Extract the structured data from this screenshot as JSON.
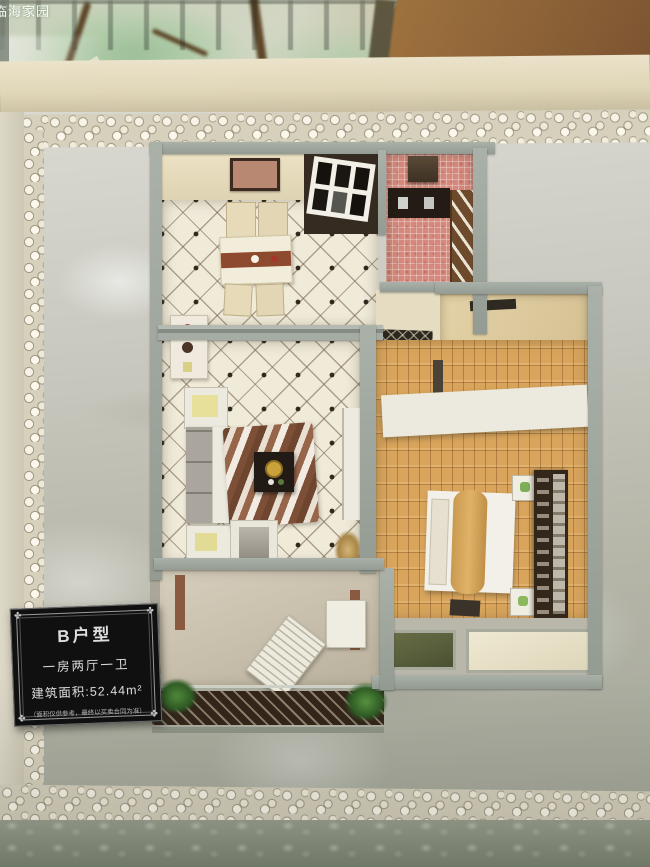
{
  "watermark": {
    "text": "临海家园"
  },
  "plaque": {
    "title": "B户型",
    "layout": "一房两厅一卫",
    "area": "建筑面积:52.44m²",
    "disclaimer": "（面积仅供参考，最终以买卖合同为准）"
  },
  "colors": {
    "marble_base": "#c9c9c0",
    "pebble": "#efe9d8",
    "wall_grey": "#9fa79f",
    "tile_cream": "#f0ead9",
    "wood_floor": "#d9a55c",
    "kitchen_pink": "#d4897c",
    "bathroom_teal": "#79b3a8",
    "balcony_plant_green": "#3f7a35",
    "entry_dark": "#362b20",
    "plaque_bg": "#101010",
    "plaque_text": "#dddddd",
    "backdrop_green": "#aecba6",
    "wood_panel_brown": "#95683c"
  }
}
